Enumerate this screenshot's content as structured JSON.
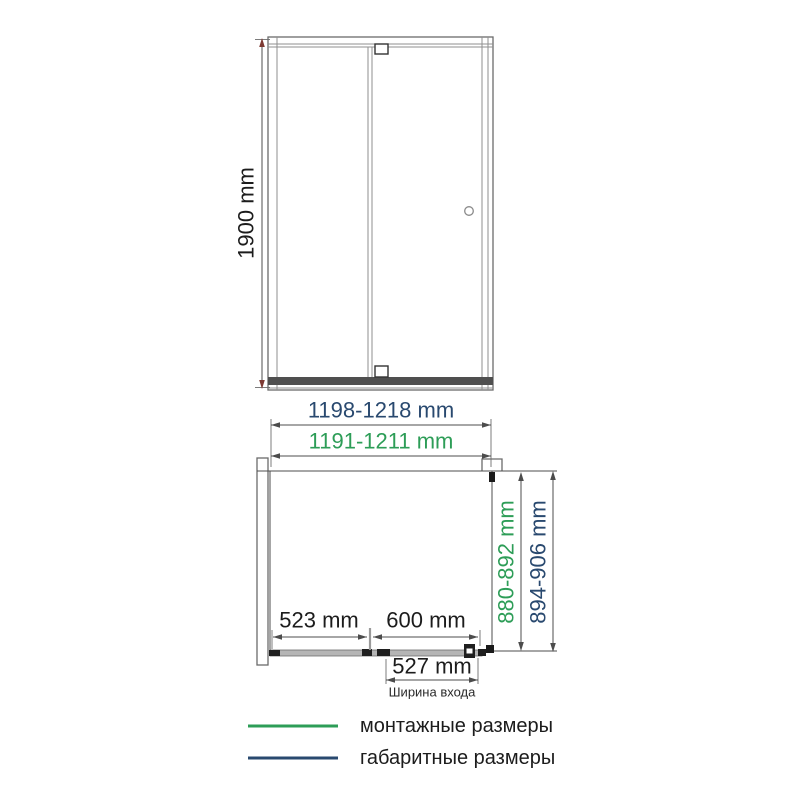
{
  "drawing": {
    "front_view": {
      "height": "1900 mm"
    },
    "plan_view": {
      "overall_width": "1198-1218 mm",
      "mounting_width": "1191-1211 mm",
      "mounting_depth": "880-892 mm",
      "overall_depth": "894-906 mm",
      "fixed_panel_width": "523 mm",
      "door_width": "600 mm",
      "entry_width": "527 mm",
      "entry_width_caption": "Ширина входа"
    }
  },
  "legend": {
    "mounting_label": "монтажные размеры",
    "overall_label": "габаритные размеры"
  },
  "colors": {
    "mounting_green": "#2d9d57",
    "overall_navy": "#29496f",
    "dimension_text_black": "#1c1c1c",
    "line_gray": "#555555",
    "arrow_maroon": "#7e3a33"
  }
}
